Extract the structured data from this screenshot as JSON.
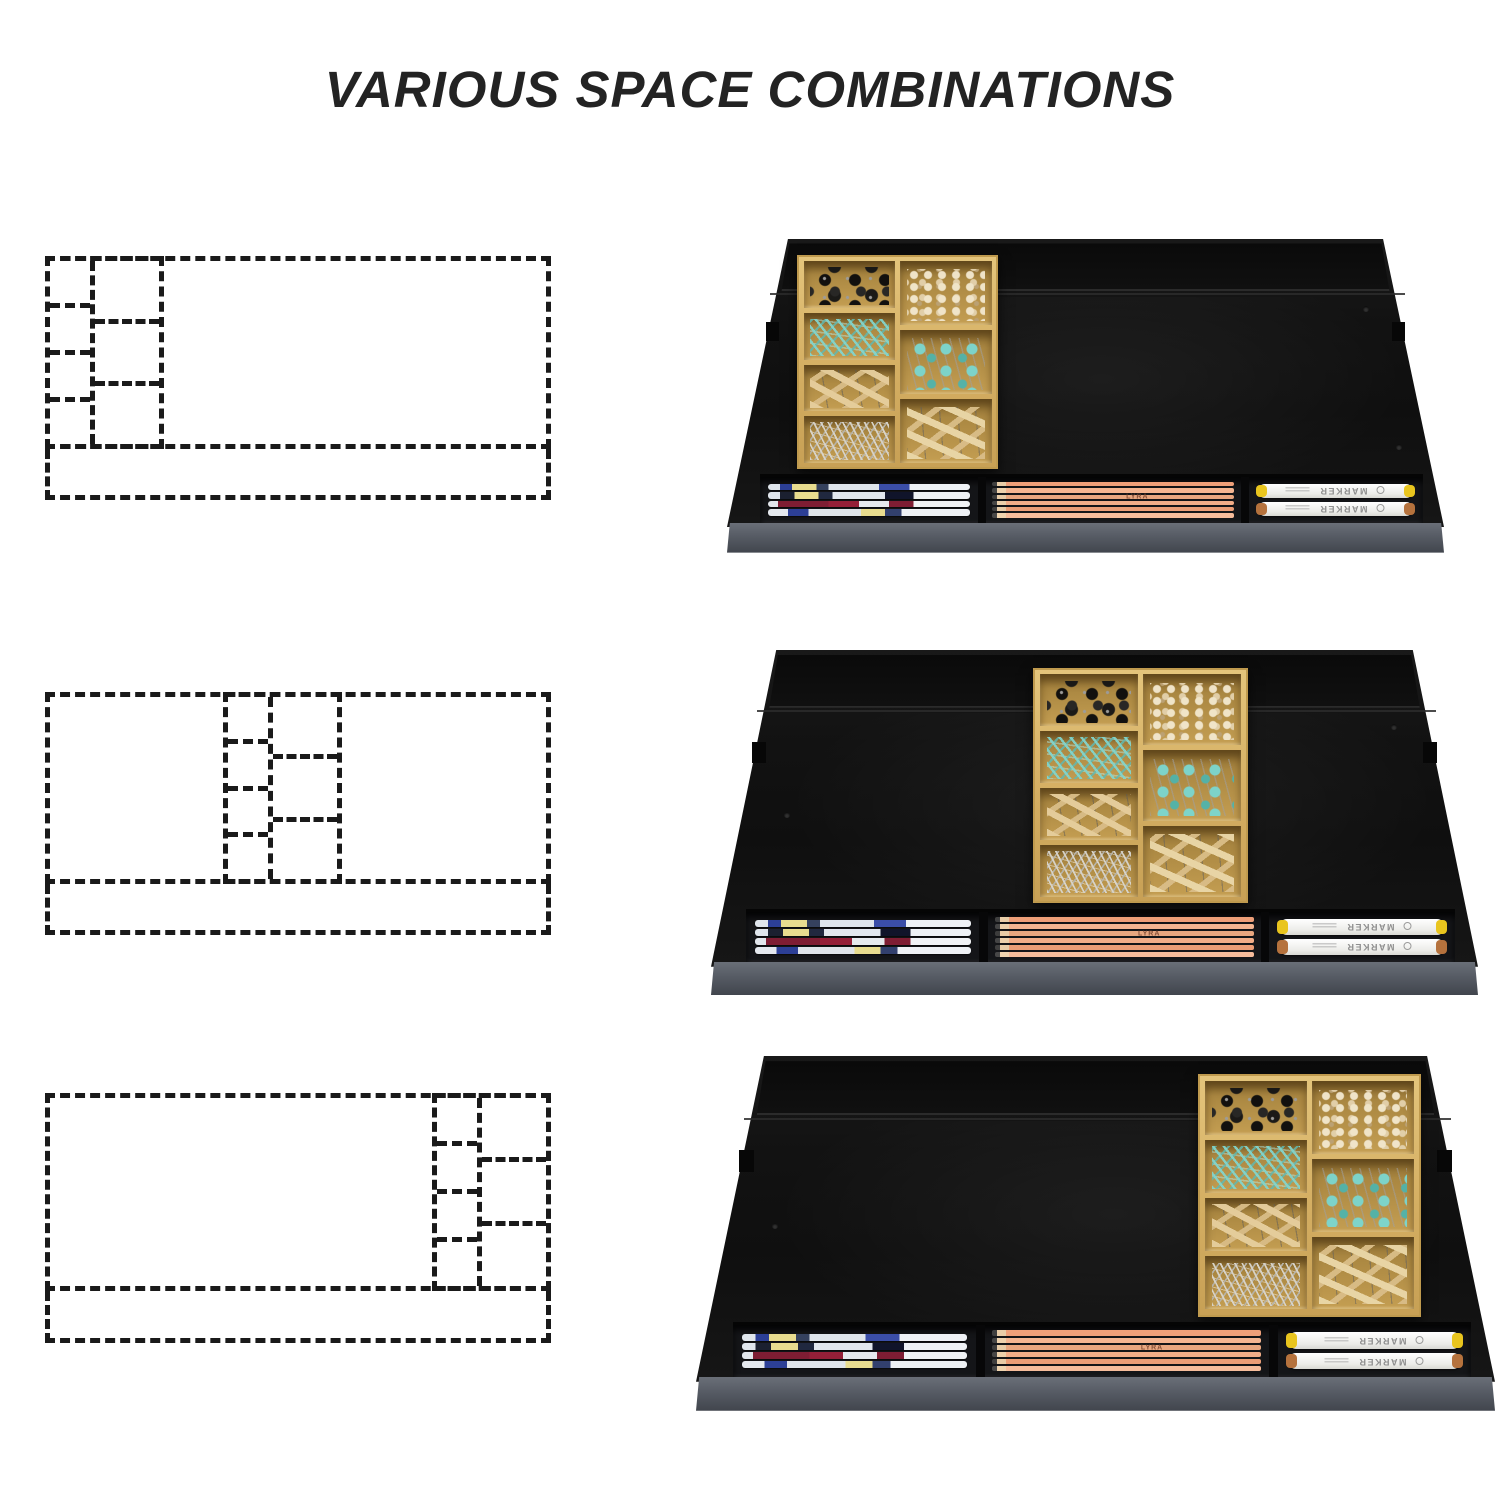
{
  "title": "VARIOUS SPACE COMBINATIONS",
  "rows": [
    {
      "name": "combination-1",
      "tray_position": "left"
    },
    {
      "name": "combination-2",
      "tray_position": "center"
    },
    {
      "name": "combination-3",
      "tray_position": "right"
    }
  ],
  "diagram": {
    "main_area": "drawer space",
    "pen_tray_strip": "front pen tray",
    "grid": {
      "left_column_cells": 4,
      "right_column_cells": 3
    },
    "line_color": "#1a1a1a"
  },
  "organizer": {
    "marker_label": "MARKER",
    "pencil_brand": "LYRA",
    "compartments": [
      {
        "item": "black binder clips",
        "color": "#1a1a1a"
      },
      {
        "item": "teal paper clips",
        "color": "#7ed3cb"
      },
      {
        "item": "wooden clothespins",
        "color": "#e0c896"
      },
      {
        "item": "silver safety pins",
        "color": "#cfccc4"
      },
      {
        "item": "cream push pins",
        "color": "#eee0c4"
      },
      {
        "item": "teal binder clips",
        "color": "#6fcac3"
      },
      {
        "item": "small wooden clothespins",
        "color": "#dcc49a"
      }
    ],
    "pen_tray_sections": [
      "gel pens",
      "pencils",
      "markers"
    ]
  },
  "colors": {
    "background": "#ffffff",
    "title_text": "#232323",
    "drawer_body": "#141414",
    "drawer_back_wall": "#0a0a0a",
    "drawer_front_lip": "#565b64",
    "bamboo_tray": "#d4ae62",
    "pencil_wood": "#eba57f",
    "marker_body": "#f2f2ef",
    "marker_cap_yellow": "#e9c51e",
    "marker_cap_copper": "#b5723d"
  }
}
